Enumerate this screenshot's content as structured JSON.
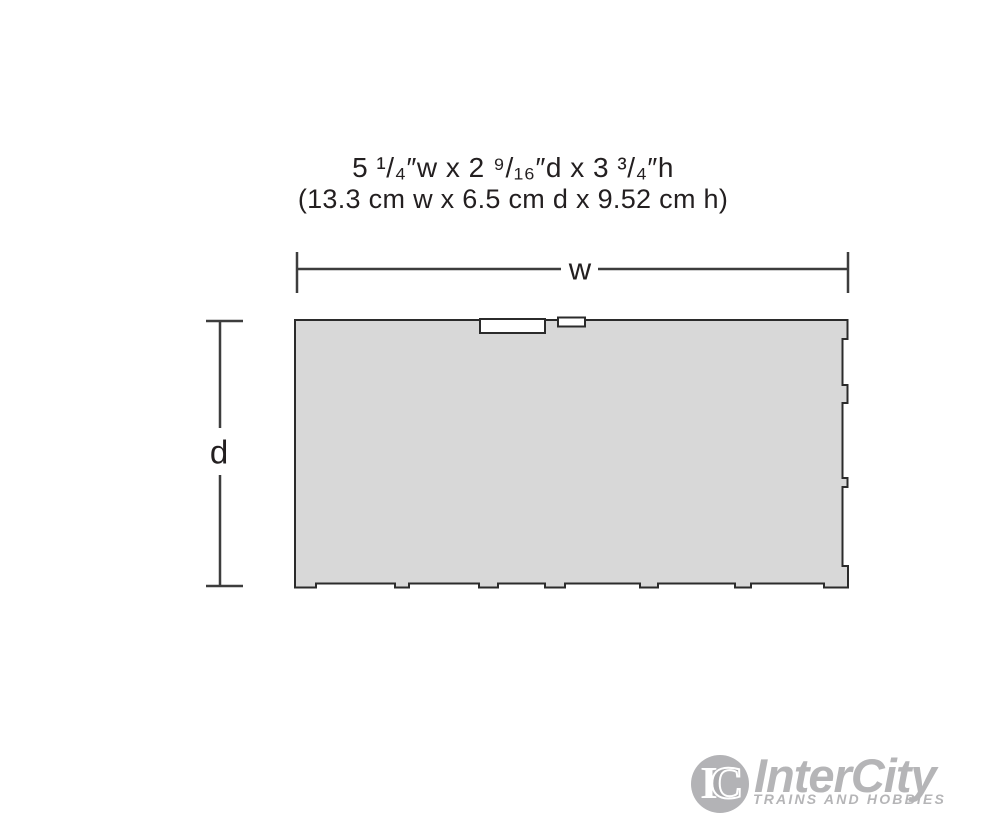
{
  "title": {
    "line_imperial": "5 ¹/₄″w x 2 ⁹/₁₆″d x 3 ³/₄″h",
    "line_metric": "(13.3 cm w x 6.5 cm d x 9.52 cm h)"
  },
  "diagram": {
    "width_label": "w",
    "depth_label": "d",
    "footprint_fill": "#d8d8d8",
    "footprint_outline": "#2b2b2b",
    "dimension_line_color": "#3d3d3d"
  },
  "logo": {
    "monogram_i": "I",
    "monogram_c": "C",
    "name": "InterCity",
    "tagline": "TRAINS AND HOBBIES",
    "color": "#b5b5b7"
  }
}
